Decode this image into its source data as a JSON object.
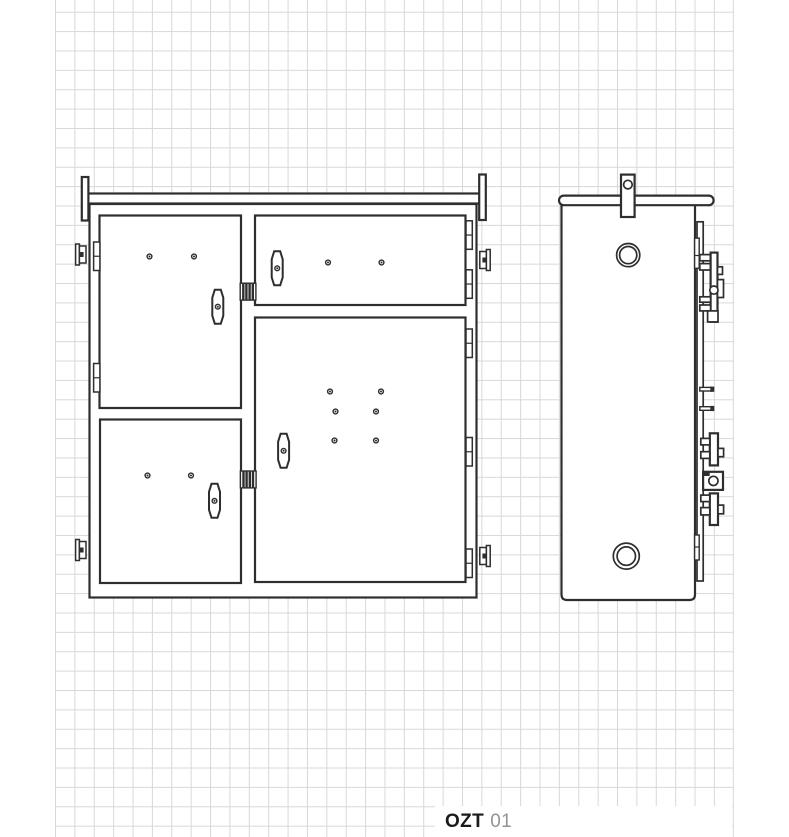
{
  "label": {
    "series": "OZT",
    "model": "01"
  },
  "colors": {
    "background": "#ffffff",
    "grid_line": "#d8d8d8",
    "drawing_line": "#2e2e2e",
    "label_series_color": "#1a1a1a",
    "label_model_color": "#919396"
  },
  "grid": {
    "cell_px": 19.38,
    "left_px": 55,
    "right_px": 733,
    "first_row_line_y": 12
  },
  "drawing": {
    "type": "technical-line-drawing",
    "views": [
      {
        "name": "front-view",
        "doors": 4,
        "door_dots": 12,
        "latches": 2,
        "wall_brackets": 4
      },
      {
        "name": "side-view",
        "round_holes": 2,
        "lock_assemblies": 2
      }
    ]
  }
}
